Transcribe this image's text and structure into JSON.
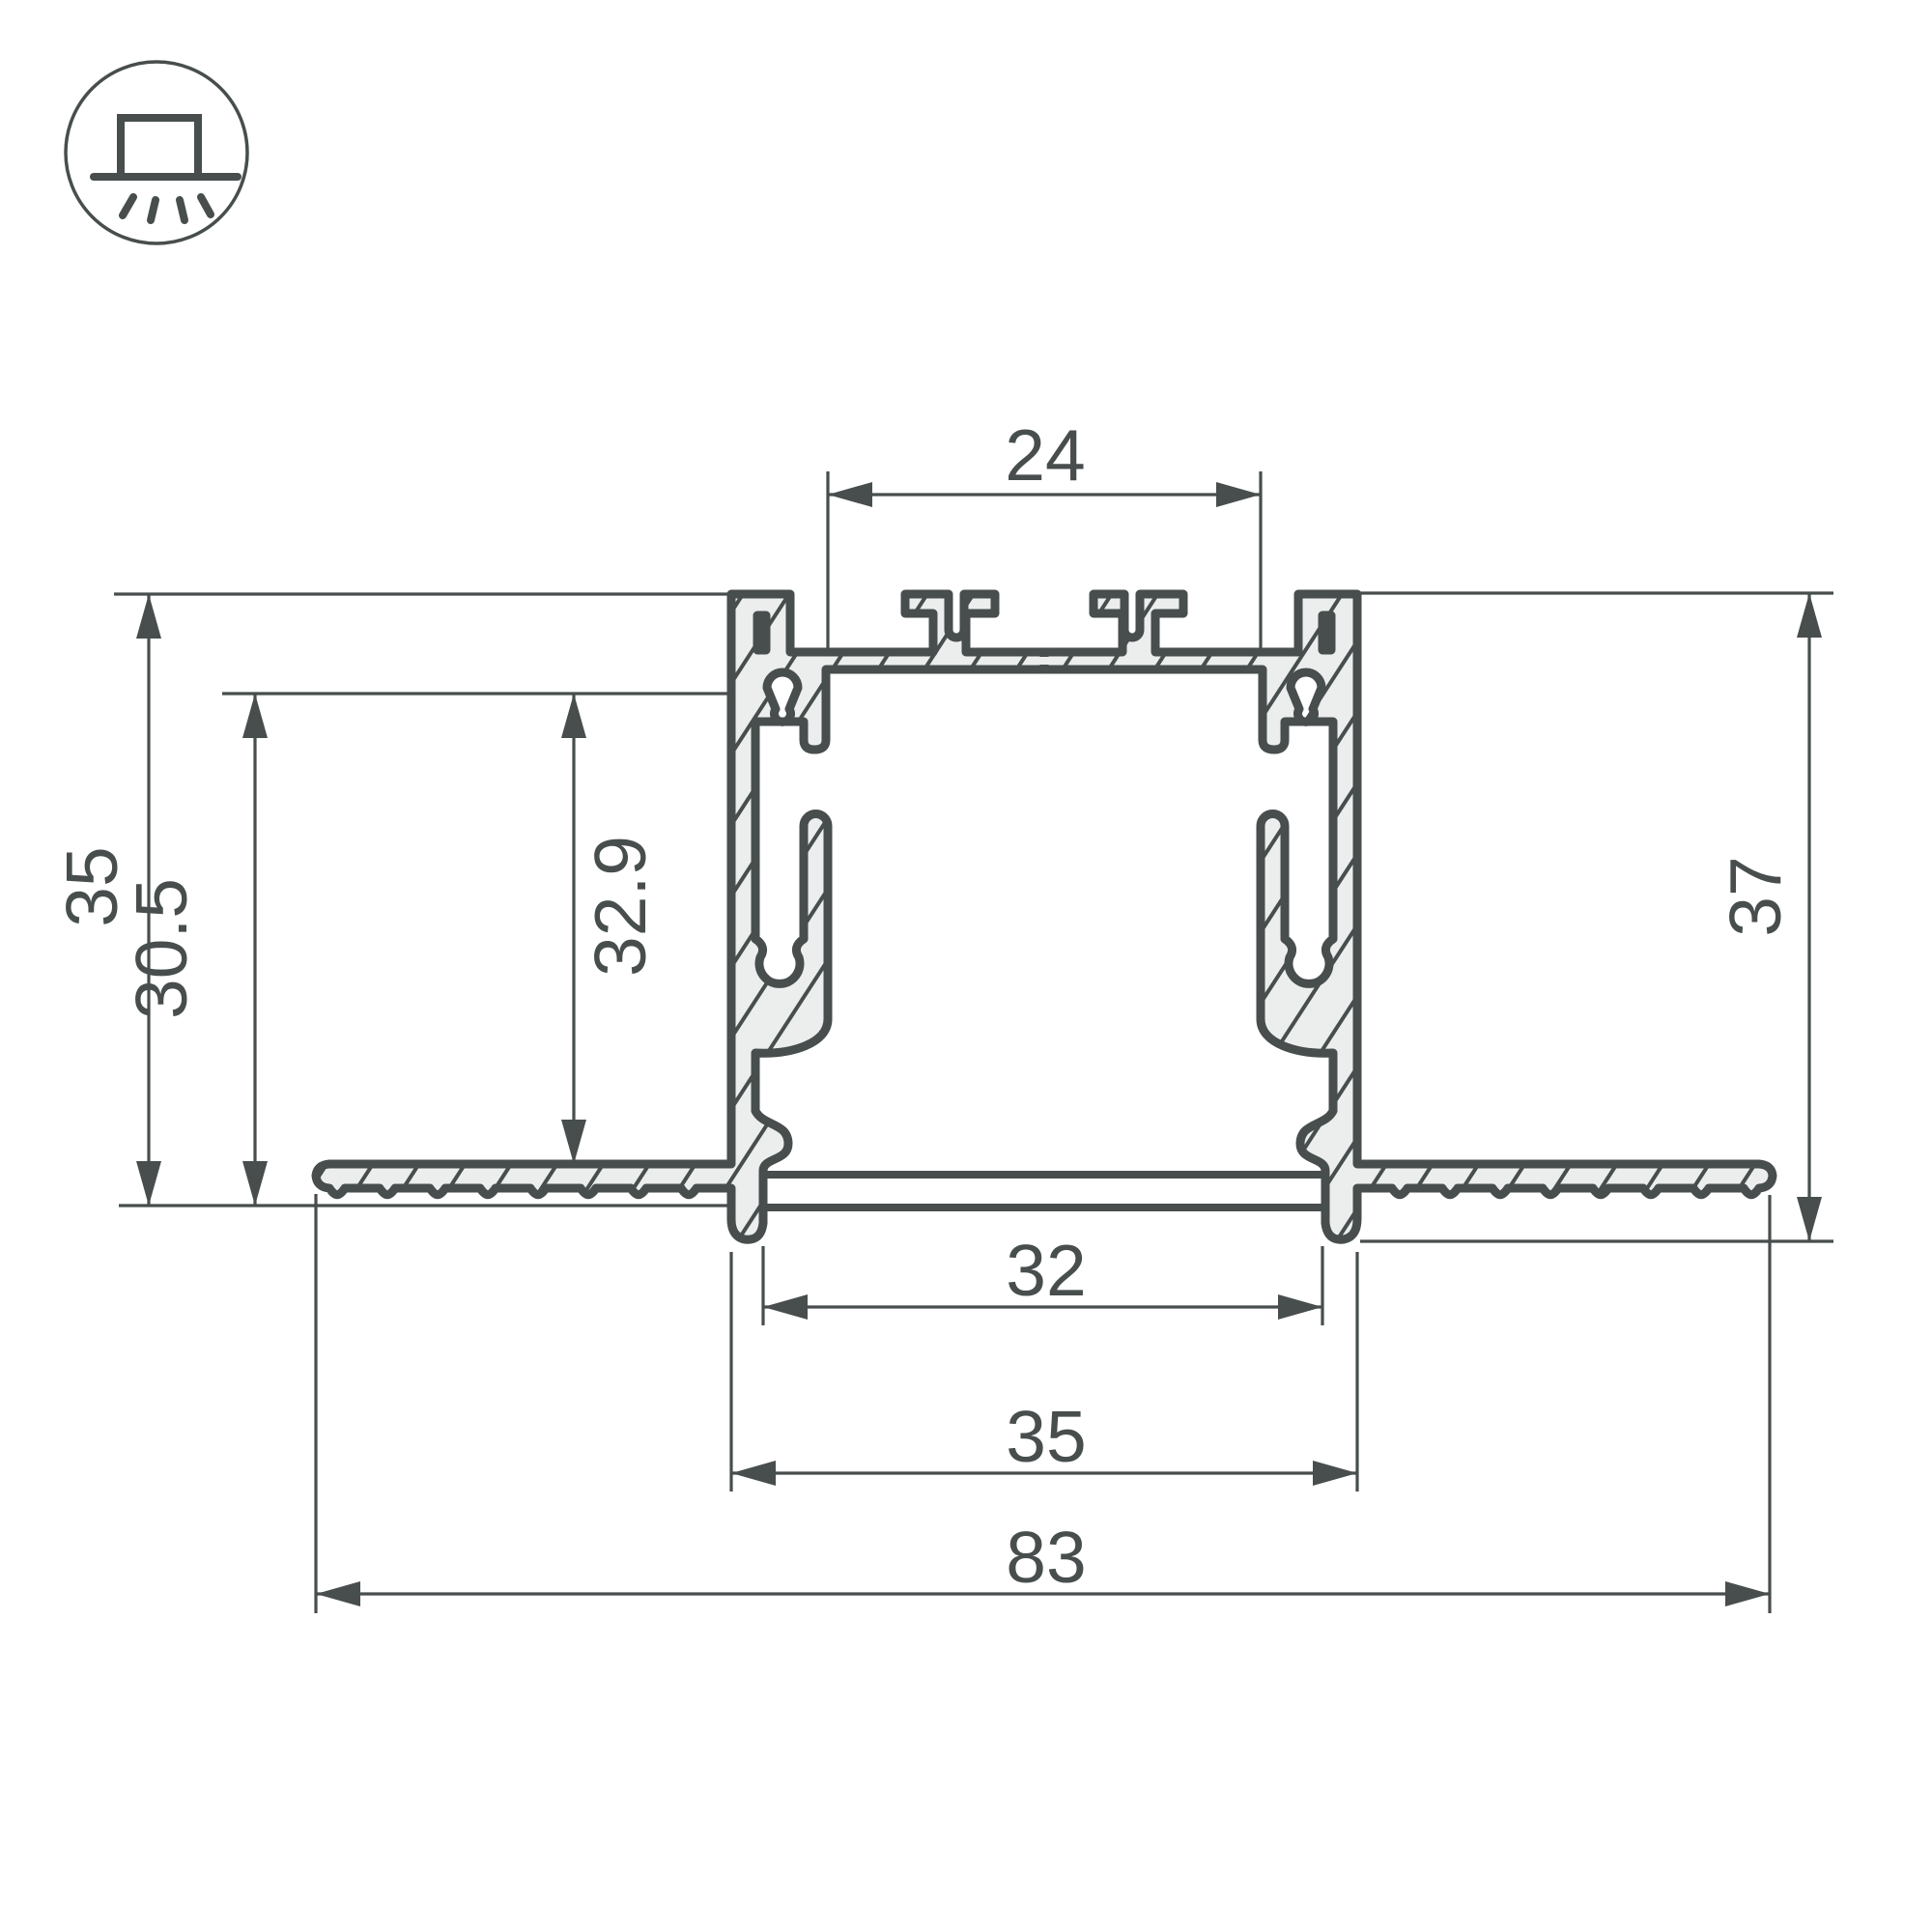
{
  "icon": {
    "name": "recessed-mount-icon",
    "description": "square fixture on ceiling line with light rays shining down"
  },
  "colors": {
    "line": "#474e4d",
    "section_fill": "#eceeee",
    "background": "#ffffff"
  },
  "drawing": {
    "type": "profile-cross-section",
    "units_implied": "mm"
  },
  "dimensions": {
    "top_slot_width": "24",
    "left_height_overall": "35",
    "left_height_inner": "30.5",
    "inner_depth": "32.9",
    "right_height": "37",
    "bottom_opening_width": "32",
    "body_width": "35",
    "overall_flange_width": "83"
  }
}
